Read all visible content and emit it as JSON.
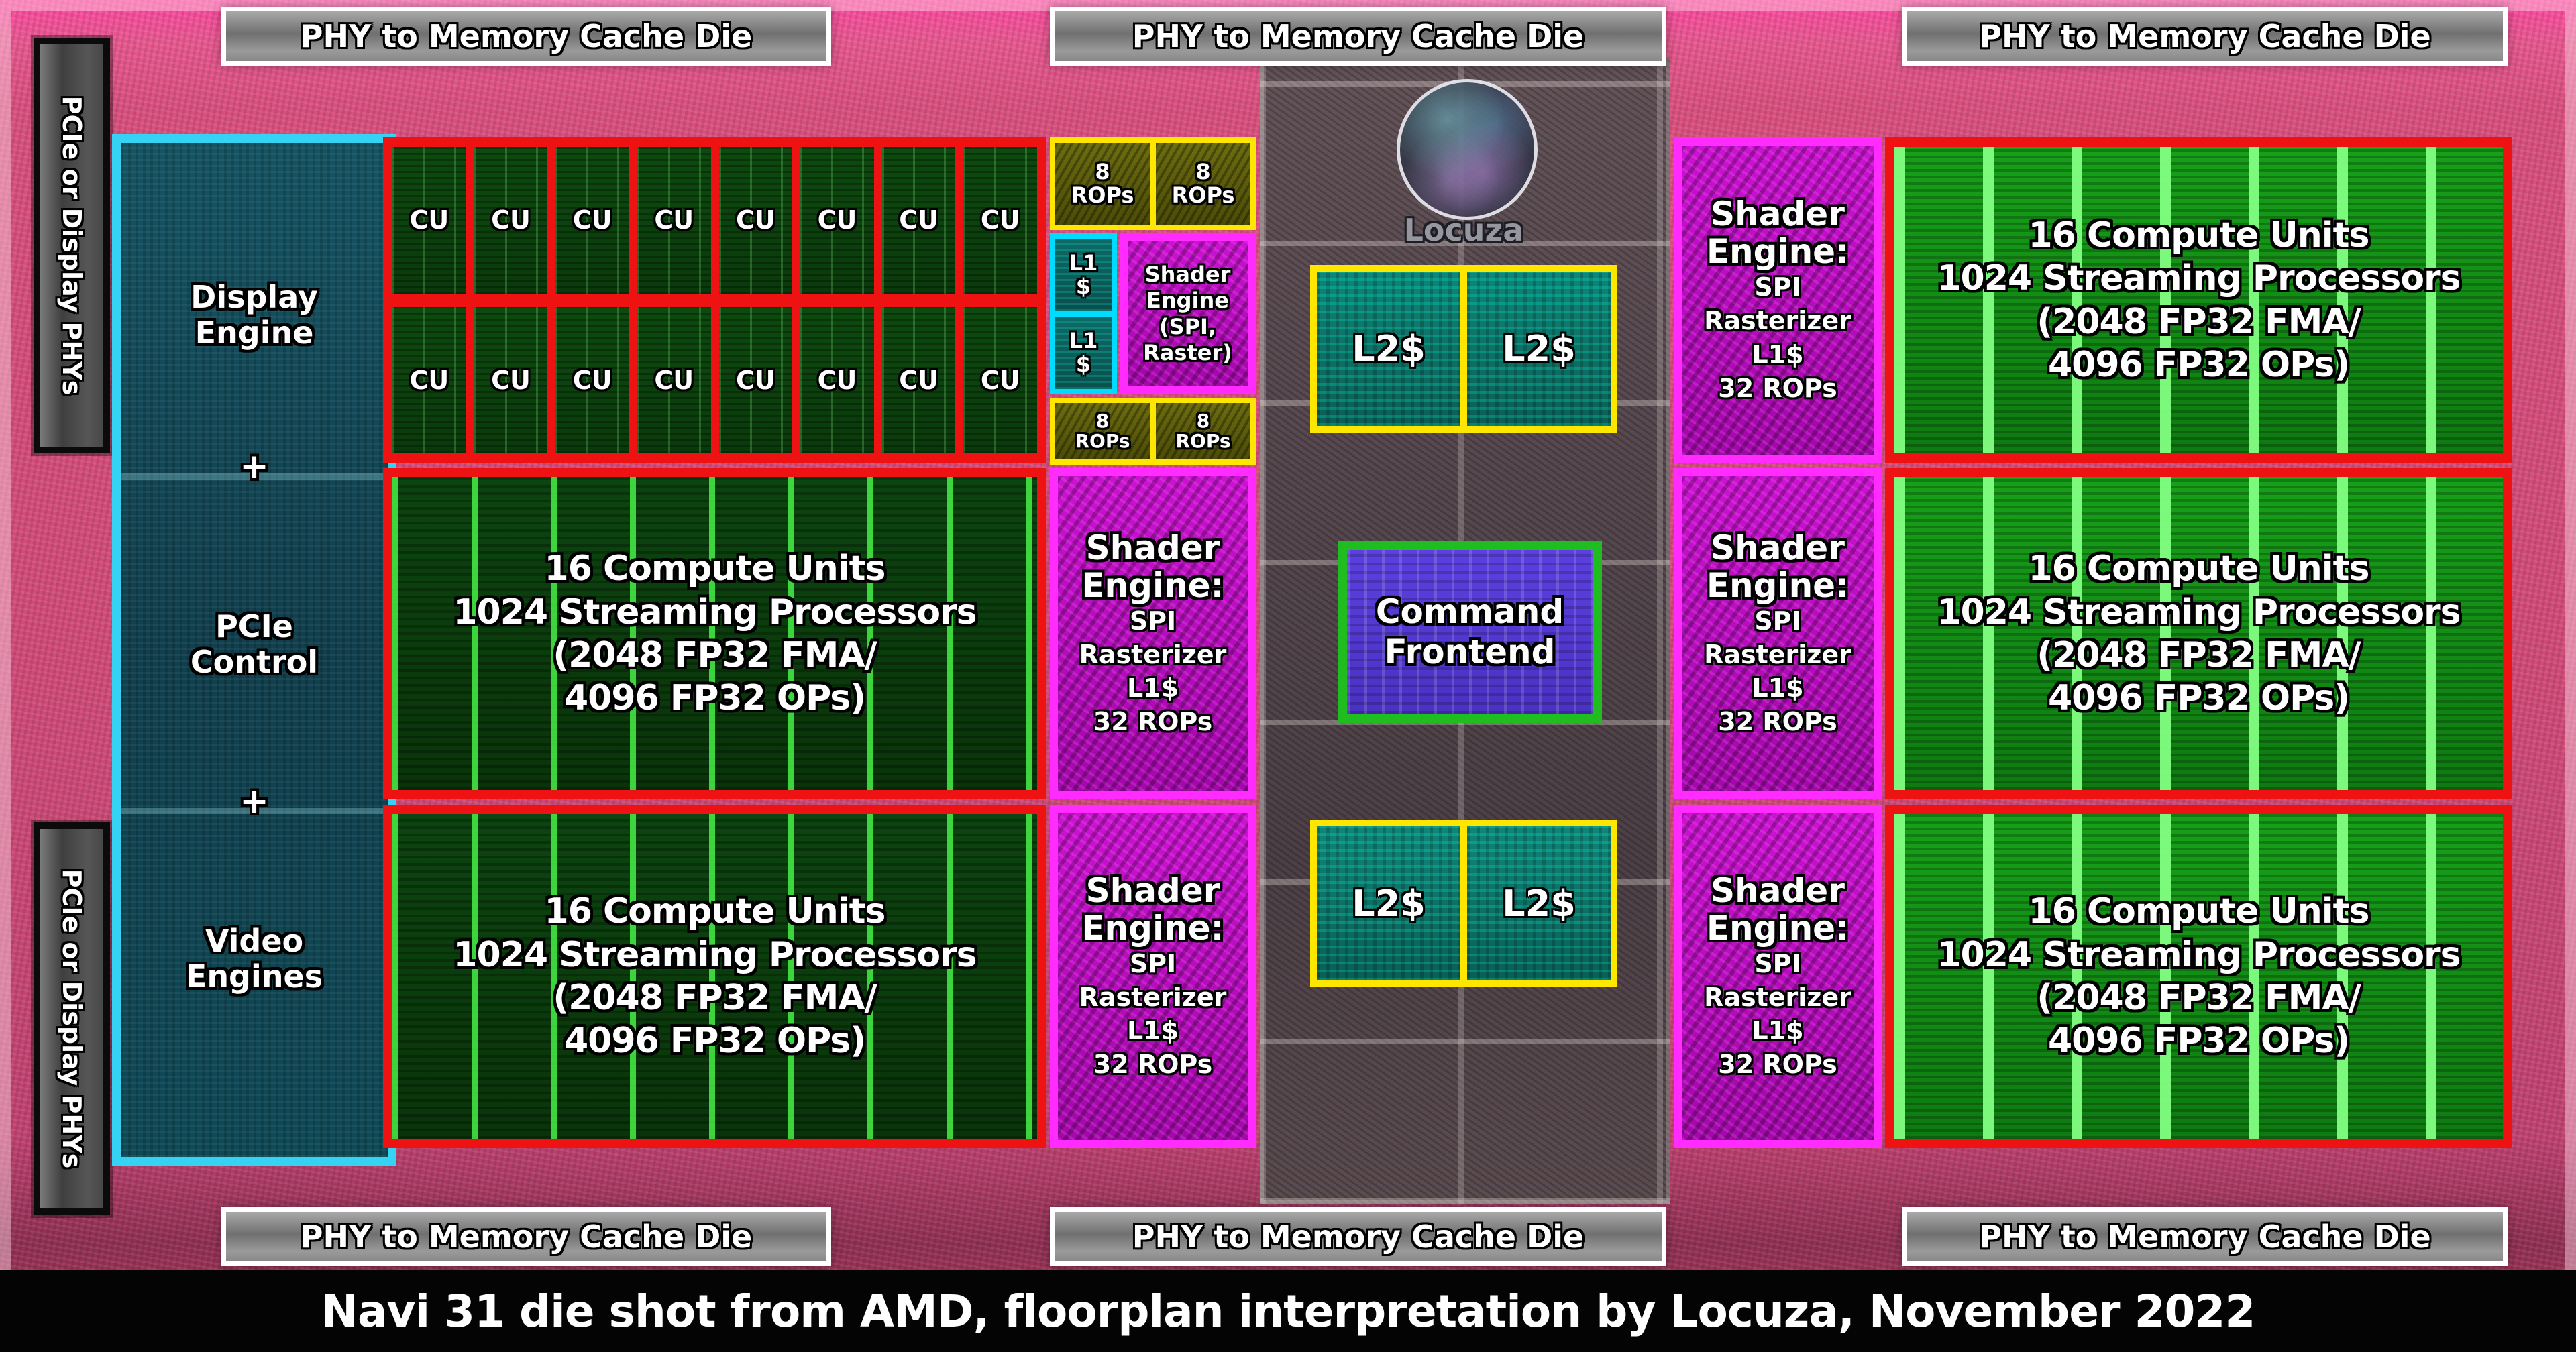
{
  "phy_labels": {
    "top": [
      "PHY to Memory Cache Die",
      "PHY to Memory Cache Die",
      "PHY to Memory Cache Die"
    ],
    "bottom": [
      "PHY to Memory Cache Die",
      "PHY to Memory Cache Die",
      "PHY to Memory Cache Die"
    ]
  },
  "side_labels": {
    "top_left": "PCIe or Display PHYs",
    "bottom_left": "PCIe or Display PHYs"
  },
  "io_block": {
    "display": "Display Engine",
    "plus_1": "+",
    "pcie": "PCIe Control",
    "plus_2": "+",
    "video": "Video Engines"
  },
  "cu_cell": "CU",
  "compute_unit_block": {
    "line_1": "16 Compute Units",
    "line_2": "1024 Streaming Processors",
    "line_3": "(2048 FP32 FMA/",
    "line_4": "4096 FP32 OPs)"
  },
  "rops_block": {
    "line_1": "8",
    "line_2": "ROPs"
  },
  "l1_cache_block": {
    "line_1": "L1",
    "line_2": "$"
  },
  "shader_engine_front": {
    "line_1": "Shader",
    "line_2": "Engine",
    "line_3": "(SPI,",
    "line_4": "Raster)"
  },
  "shader_engine": {
    "title_1": "Shader",
    "title_2": "Engine:",
    "sub_1": "SPI",
    "sub_2": "Rasterizer",
    "sub_3": "L1$",
    "sub_4": "32 ROPs"
  },
  "l2_cache_block": "L2$",
  "command_frontend": {
    "line_1": "Command",
    "line_2": "Frontend"
  },
  "watermark": "Locuza",
  "caption": "Navi 31 die shot from AMD, floorplan interpretation by Locuza, November 2022",
  "palette": {
    "annotation_red": "#ee1212",
    "annotation_yellow": "#ffe600",
    "annotation_cyan": "#35d2f4",
    "annotation_magenta": "#ff2bff",
    "annotation_green": "#1fbd1f",
    "compute_green_dark": "#0c4510",
    "compute_green_bright": "#17a019",
    "teal_cache_fill": "#0f8578",
    "olive_rops_fill": "#5d5d08",
    "magenta_shader_fill": "#b80cbe",
    "purple_command_fill": "#5340d0",
    "io_teal_fill": "#124e5c",
    "phy_label_gray": "#8a8a8a",
    "background_pink": "#d94f7e",
    "caption_bg": "#000000",
    "text_white": "#ffffff",
    "watermark_gray": "#96969f"
  }
}
